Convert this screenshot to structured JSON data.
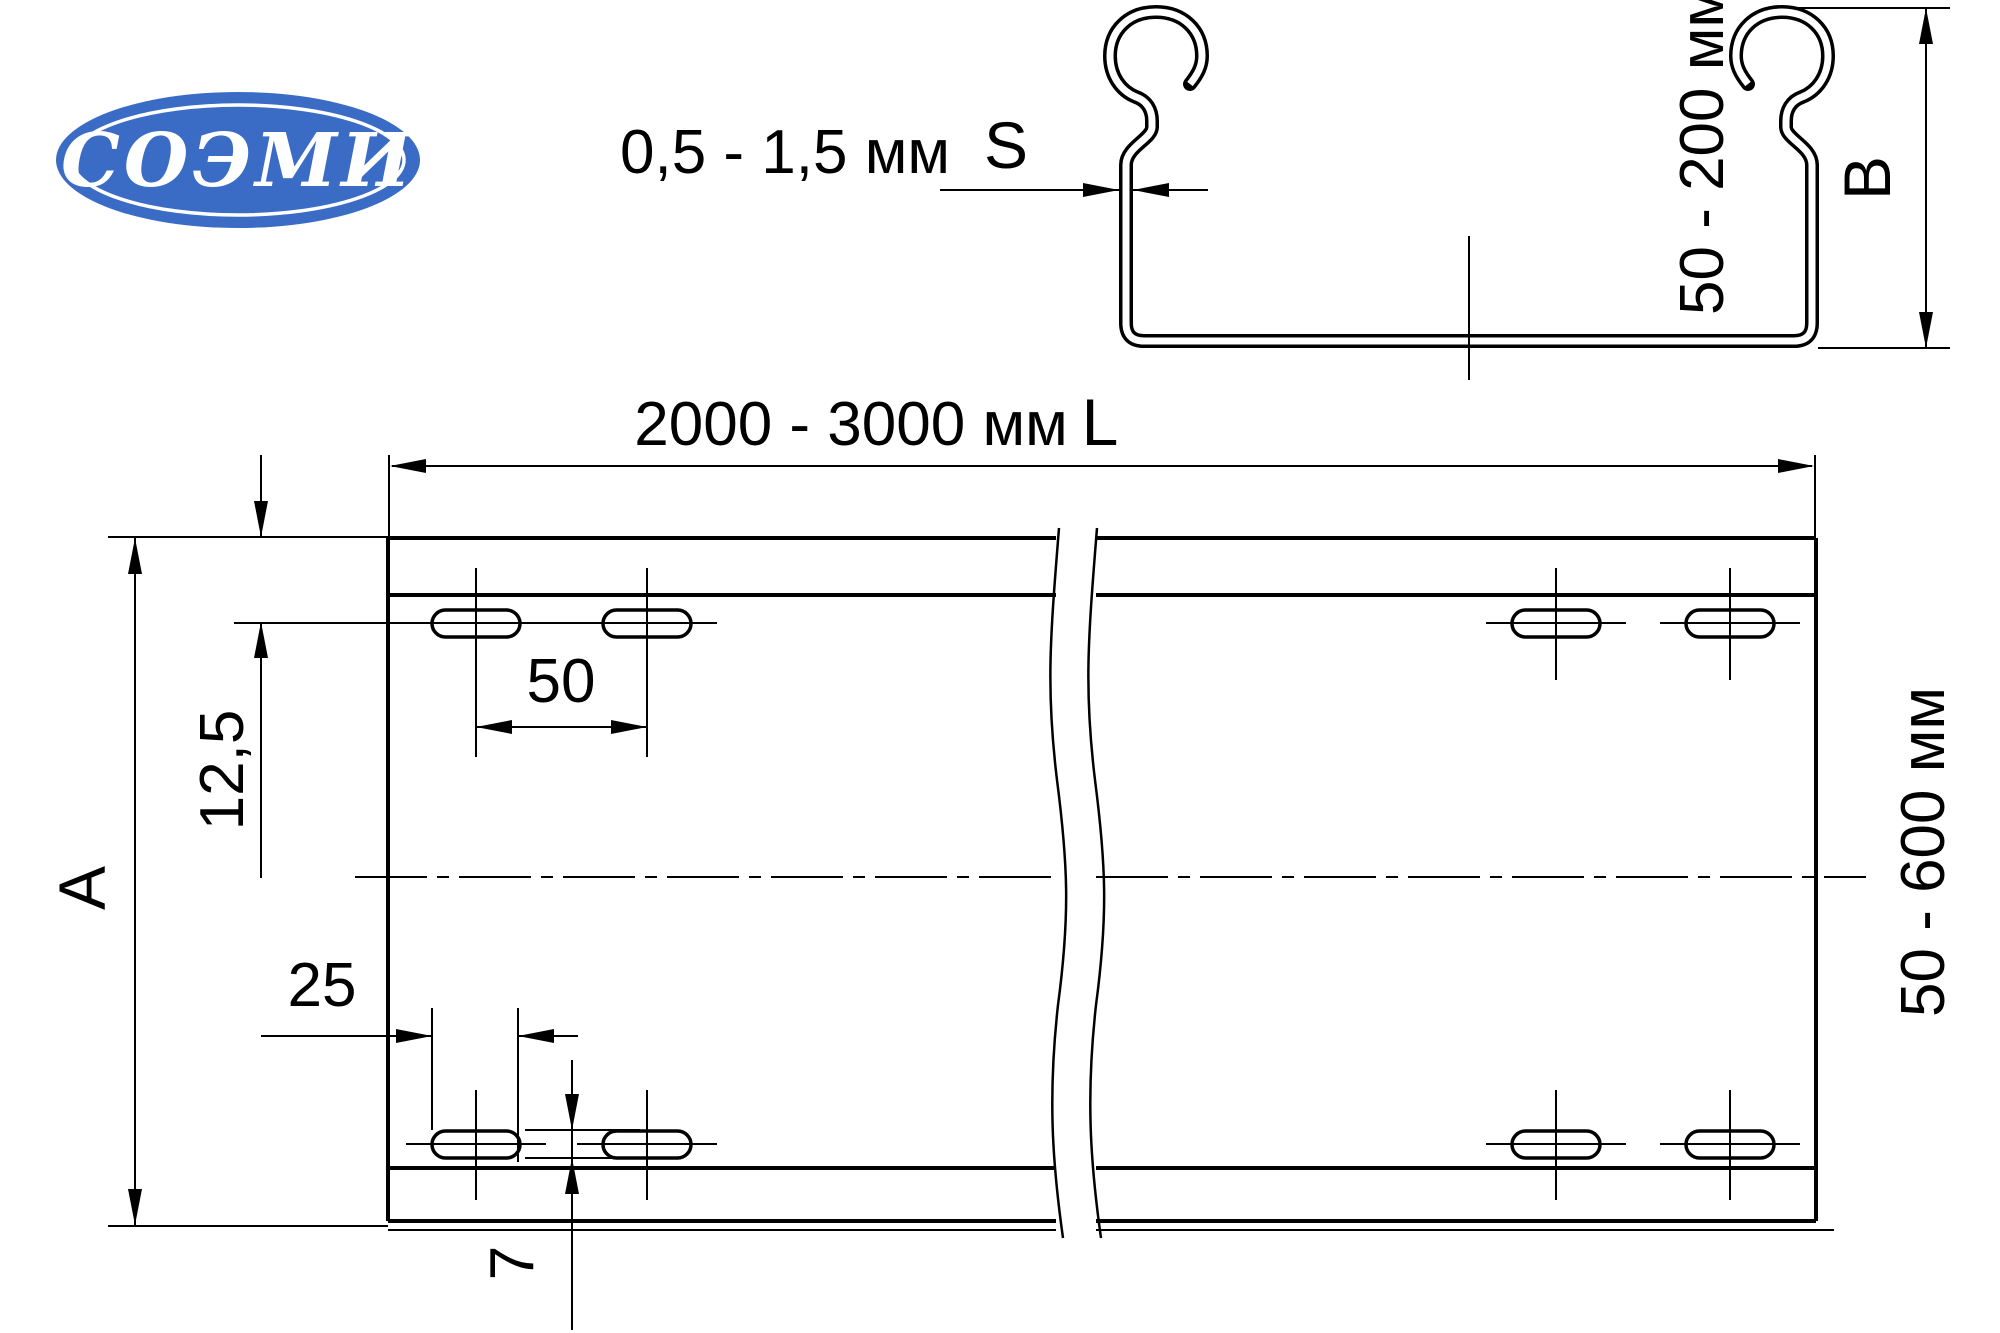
{
  "page": {
    "background": "#ffffff",
    "line_color": "#000000"
  },
  "logo": {
    "text": "СОЭМИ",
    "bg_color": "#3b6cc5",
    "text_color": "#ffffff"
  },
  "section_view": {
    "thickness_label": "0,5 - 1,5 мм",
    "thickness_symbol": "S",
    "height_range_label": "50 - 200 мм",
    "height_symbol": "B"
  },
  "plan_view": {
    "length_label": "2000 - 3000 мм",
    "length_symbol": "L",
    "width_range_label": "50 - 600 мм",
    "width_symbol": "A",
    "dim_edge_to_holes": "12,5",
    "dim_hole_spacing": "50",
    "dim_hole_length": "25",
    "dim_hole_width": "7"
  }
}
